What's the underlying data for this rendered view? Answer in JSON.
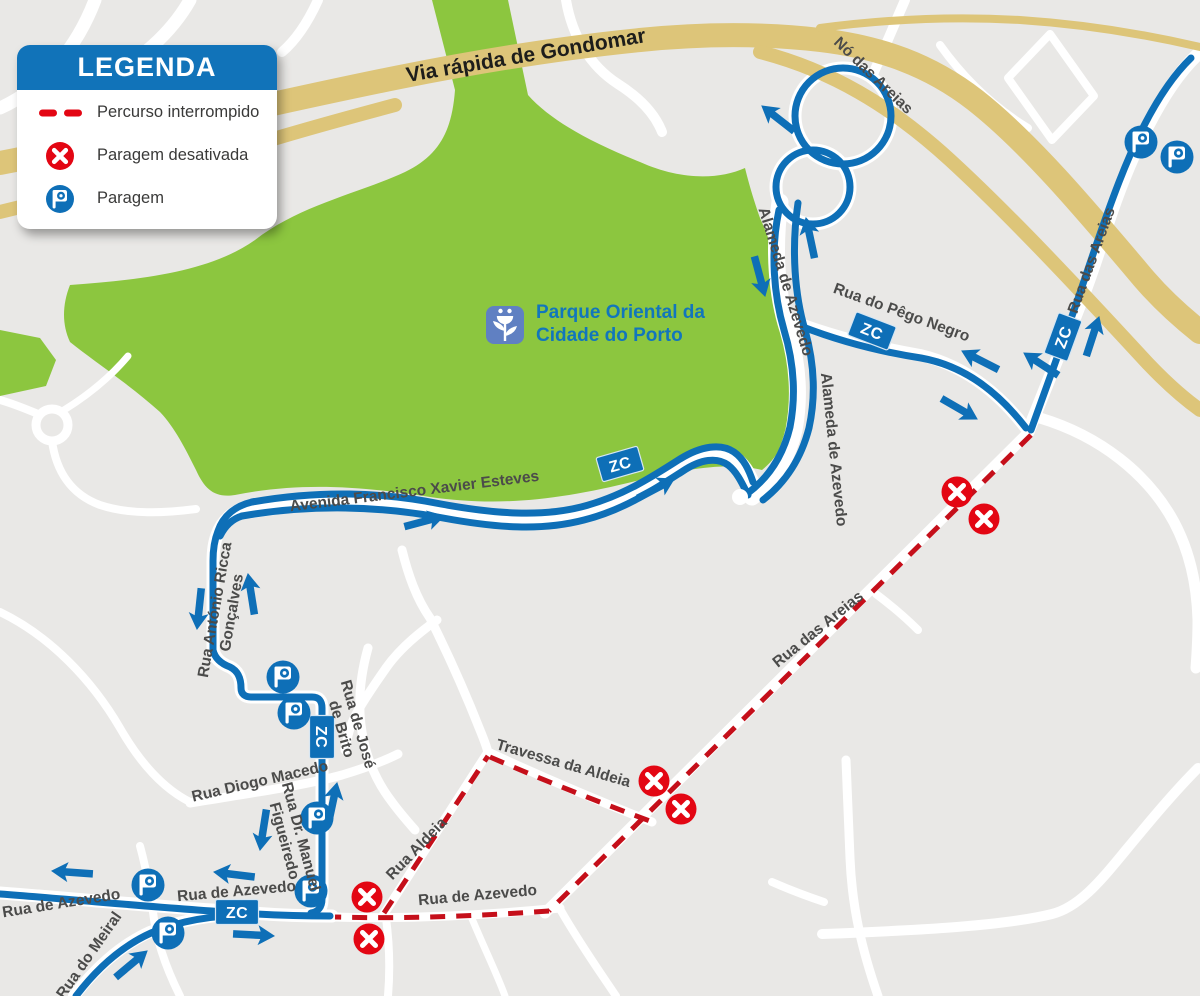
{
  "legend": {
    "title": "LEGENDA",
    "items": [
      {
        "icon": "dashed-line-icon",
        "label": "Percurso interrompido"
      },
      {
        "icon": "disabled-stop-icon",
        "label": "Paragem desativada"
      },
      {
        "icon": "bus-stop-icon",
        "label": "Paragem"
      }
    ]
  },
  "park_label": {
    "line1": "Parque Oriental da",
    "line2": "Cidade do Porto"
  },
  "map": {
    "zc_label": "ZC",
    "street_labels": [
      {
        "id": "via-rapida-gondomar",
        "text": "Via rápida de Gondomar",
        "x": 527,
        "y": 62,
        "rot": -9.5,
        "size": 21,
        "color": "#1d1d1b"
      },
      {
        "id": "no-das-areias",
        "text": "Nó das Areias",
        "x": 870,
        "y": 79,
        "rot": 44
      },
      {
        "id": "rua-das-areias-ne",
        "text": "Rua das Areias",
        "x": 1096,
        "y": 262,
        "rot": -70
      },
      {
        "id": "alameda-de-azevedo-upper",
        "text": "Alameda de Azevedo",
        "x": 781,
        "y": 283,
        "rot": 73
      },
      {
        "id": "rua-do-pego-negro",
        "text": "Rua do Pêgo Negro",
        "x": 900,
        "y": 317,
        "rot": 20
      },
      {
        "id": "alameda-de-azevedo-lower",
        "text": "Alameda de Azevedo",
        "x": 829,
        "y": 450,
        "rot": 84
      },
      {
        "id": "avenida-francisco-xavier-esteves",
        "text": "Avenida Francisco Xavier Esteves",
        "x": 415,
        "y": 496,
        "rot": -7
      },
      {
        "id": "rua-antonio-ricca-goncalves",
        "lines": [
          "Rua António Ricca",
          "Gonçalves"
        ],
        "x": 228,
        "y": 612,
        "rot": -80
      },
      {
        "id": "rua-de-jose-de-brito",
        "lines": [
          "Rua de José",
          "de Brito"
        ],
        "x": 345,
        "y": 728,
        "rot": 74
      },
      {
        "id": "rua-diogo-macedo",
        "text": "Rua Diogo Macedo",
        "x": 261,
        "y": 786,
        "rot": -13
      },
      {
        "id": "rua-dr-manuel-figueiredo",
        "lines": [
          "Rua Dr. Manuel",
          "Figueiredo"
        ],
        "x": 288,
        "y": 840,
        "rot": 75
      },
      {
        "id": "rua-aldeia",
        "text": "Rua Aldeia",
        "x": 420,
        "y": 852,
        "rot": -46
      },
      {
        "id": "travessa-da-aldeia",
        "text": "Travessa da Aldeia",
        "x": 562,
        "y": 768,
        "rot": 16
      },
      {
        "id": "rua-de-azevedo-center",
        "text": "Rua de Azevedo",
        "x": 478,
        "y": 900,
        "rot": -5
      },
      {
        "id": "rua-de-azevedo-left",
        "text": "Rua de Azevedo",
        "x": 62,
        "y": 908,
        "rot": -9
      },
      {
        "id": "rua-de-azevedo-mid",
        "text": "Rua de Azevedo",
        "x": 237,
        "y": 896,
        "rot": -5
      },
      {
        "id": "rua-do-meiral",
        "text": "Rua do Meiral",
        "x": 93,
        "y": 958,
        "rot": -55
      },
      {
        "id": "rua-das-areias-red",
        "text": "Rua das Areias",
        "x": 821,
        "y": 633,
        "rot": -39
      }
    ],
    "bus_stops": [
      {
        "x": 1141,
        "y": 142
      },
      {
        "x": 1177,
        "y": 157
      },
      {
        "x": 283,
        "y": 677
      },
      {
        "x": 294,
        "y": 713
      },
      {
        "x": 317,
        "y": 818
      },
      {
        "x": 311,
        "y": 891
      },
      {
        "x": 148,
        "y": 885
      },
      {
        "x": 168,
        "y": 933
      }
    ],
    "disabled_stops": [
      {
        "x": 957,
        "y": 492
      },
      {
        "x": 984,
        "y": 519
      },
      {
        "x": 654,
        "y": 781
      },
      {
        "x": 681,
        "y": 809
      },
      {
        "x": 367,
        "y": 897
      },
      {
        "x": 369,
        "y": 939
      }
    ],
    "zc_badges": [
      {
        "x": 872,
        "y": 331,
        "rot": 21
      },
      {
        "x": 1063,
        "y": 337,
        "rot": -70
      },
      {
        "x": 620,
        "y": 464,
        "rot": -16
      },
      {
        "x": 322,
        "y": 737,
        "rot": 90
      },
      {
        "x": 237,
        "y": 912,
        "rot": 0
      }
    ],
    "arrows": [
      {
        "x": 762,
        "y": 106,
        "rot": 218
      },
      {
        "x": 765,
        "y": 296,
        "rot": 75
      },
      {
        "x": 806,
        "y": 218,
        "rot": 258
      },
      {
        "x": 962,
        "y": 351,
        "rot": 207
      },
      {
        "x": 977,
        "y": 419,
        "rot": 30
      },
      {
        "x": 1024,
        "y": 353,
        "rot": 213
      },
      {
        "x": 1099,
        "y": 317,
        "rot": 288
      },
      {
        "x": 444,
        "y": 516,
        "rot": 345
      },
      {
        "x": 674,
        "y": 479,
        "rot": 332
      },
      {
        "x": 197,
        "y": 629,
        "rot": 96
      },
      {
        "x": 248,
        "y": 574,
        "rot": 261
      },
      {
        "x": 337,
        "y": 783,
        "rot": 282
      },
      {
        "x": 260,
        "y": 850,
        "rot": 99
      },
      {
        "x": 52,
        "y": 871,
        "rot": 184
      },
      {
        "x": 214,
        "y": 872,
        "rot": 187
      },
      {
        "x": 274,
        "y": 936,
        "rot": 3
      },
      {
        "x": 147,
        "y": 951,
        "rot": 320
      }
    ]
  },
  "colors": {
    "bg": "#e9e8e6",
    "road_white": "#ffffff",
    "park_green": "#8cc63f",
    "highway_tan": "#ddc579",
    "route_blue": "#0e6fb7",
    "dash_red": "#c50f1a",
    "alert_red": "#e30613",
    "label_gray": "#4b4b4a",
    "park_text_blue": "#1276bc",
    "park_icon_blue": "#6080c2",
    "legend_blue": "#1173b9"
  }
}
